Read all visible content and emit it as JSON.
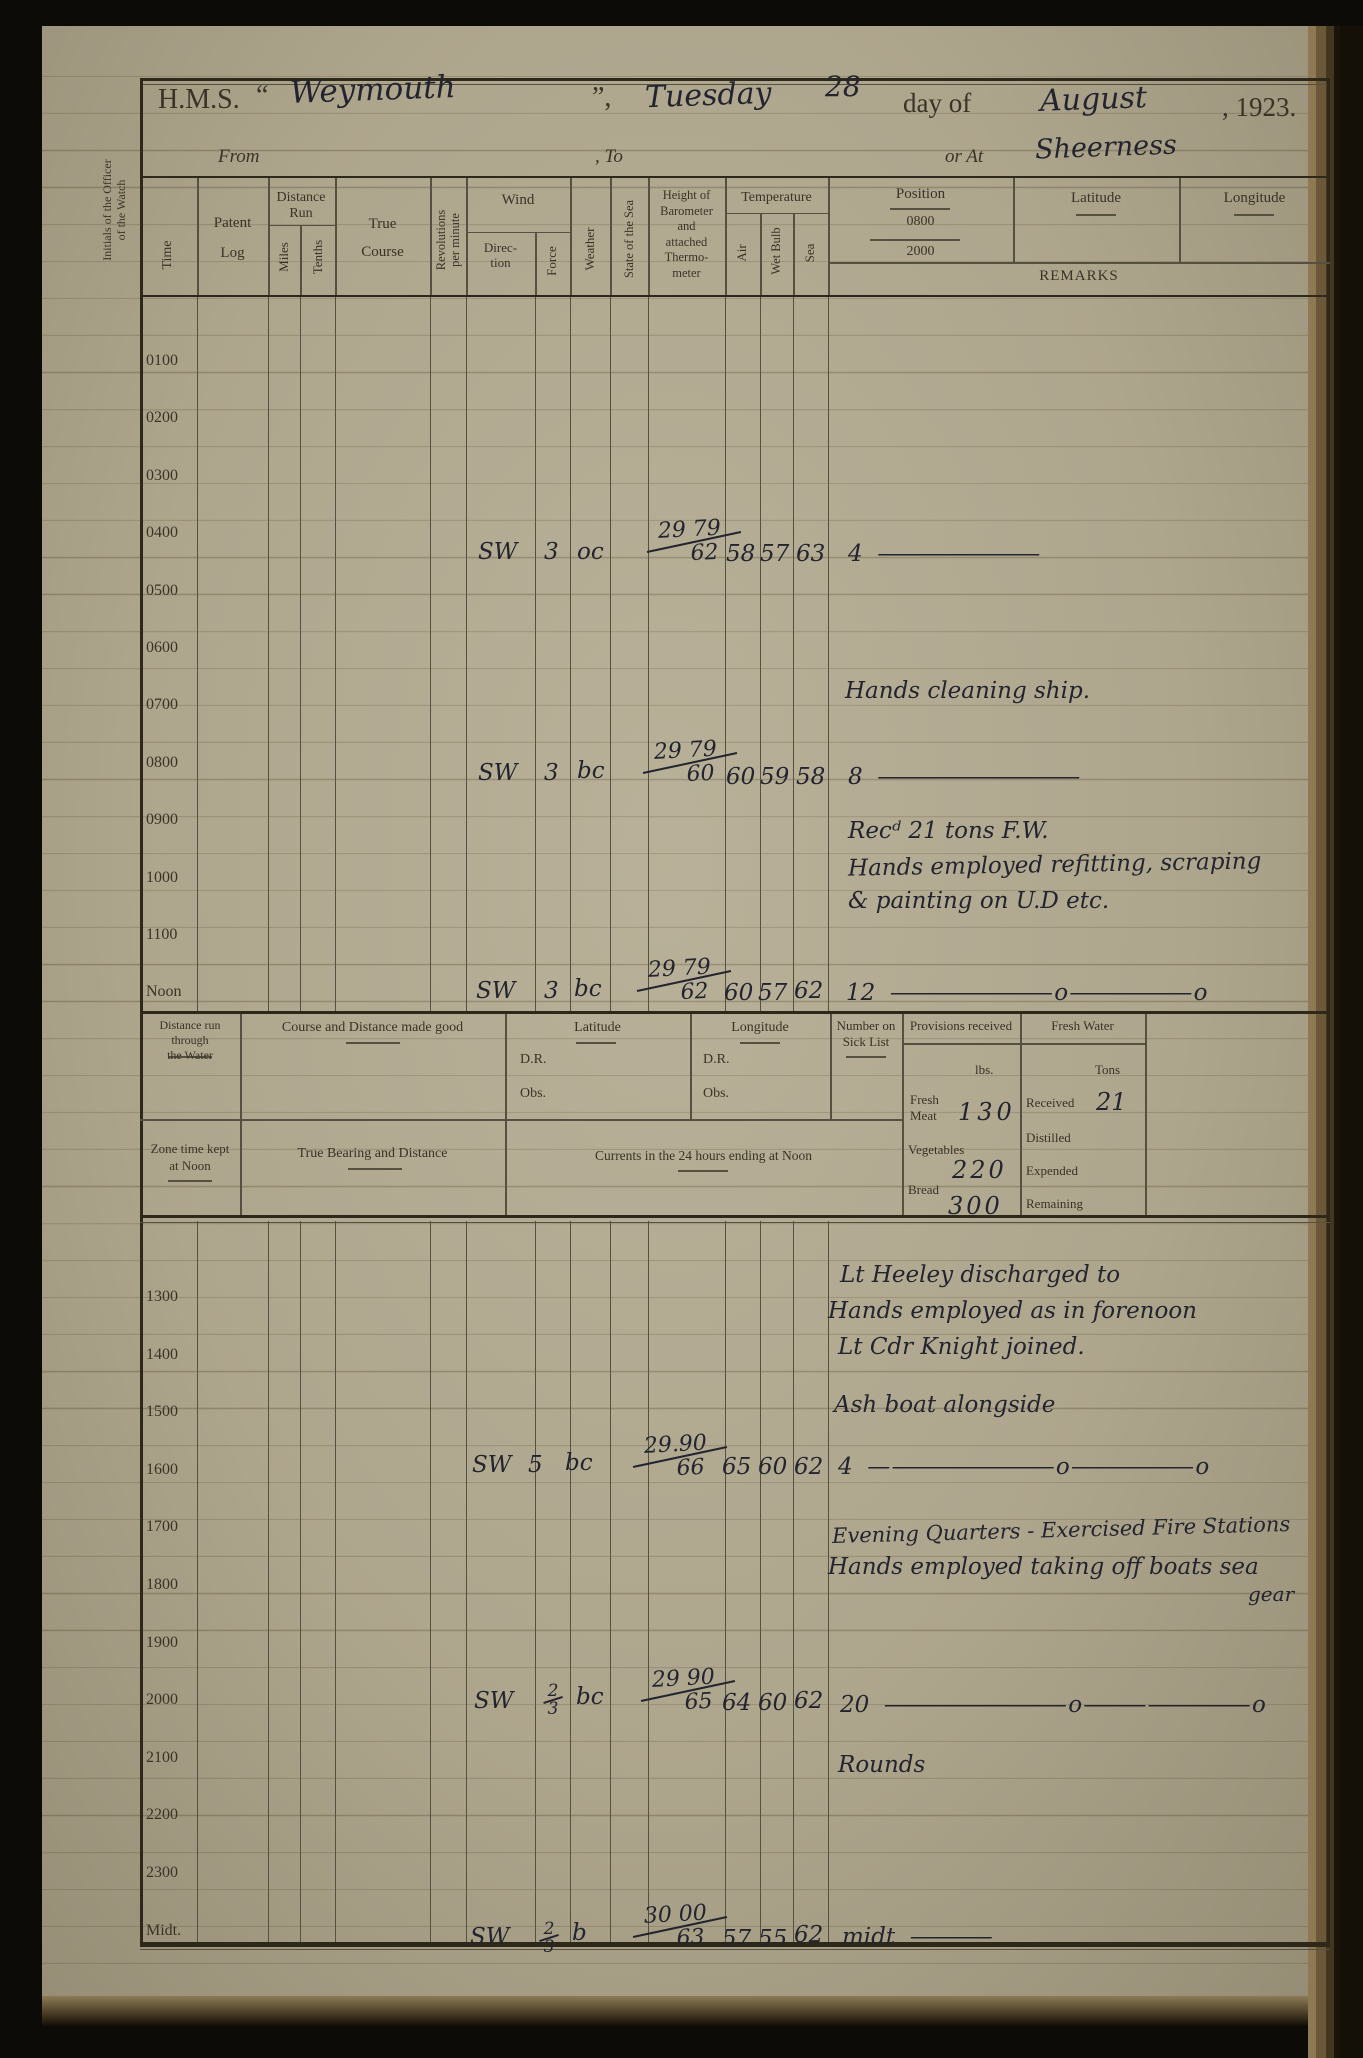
{
  "margin_note_1": "Initials of the Officer",
  "margin_note_2": "of the Watch",
  "title": {
    "hms": "H.M.S.",
    "quote_open": "“",
    "ship": "Weymouth",
    "quote_close": "”,",
    "weekday": "Tuesday",
    "day_num": "28",
    "day_of": "day of",
    "month": "August",
    "year": ", 1923."
  },
  "subtitle": {
    "from": "From",
    "to": ", To",
    "or_at": "or At",
    "place": "Sheerness"
  },
  "headers": {
    "time": "Time",
    "patent_1": "Patent",
    "patent_2": "Log",
    "distance_run": "Distance Run",
    "miles": "Miles",
    "tenths": "Tenths",
    "true_1": "True",
    "true_2": "Course",
    "rev_1": "Revolutions",
    "rev_2": "per minute",
    "wind": "Wind",
    "direction_1": "Direc-",
    "direction_2": "tion",
    "force": "Force",
    "weather": "Weather",
    "state_sea": "State of the Sea",
    "baro_1": "Height of",
    "baro_2": "Barometer",
    "baro_3": "and",
    "baro_4": "attached",
    "baro_5": "Thermo-",
    "baro_6": "meter",
    "temperature": "Temperature",
    "air": "Air",
    "wet_bulb": "Wet Bulb",
    "sea": "Sea",
    "position": "Position",
    "pos_0800": "0800",
    "pos_2000": "2000",
    "latitude": "Latitude",
    "longitude": "Longitude",
    "remarks": "REMARKS"
  },
  "times_morning": [
    "0100",
    "0200",
    "0300",
    "0400",
    "0500",
    "0600",
    "0700",
    "0800",
    "0900",
    "1000",
    "1100",
    "Noon"
  ],
  "times_afternoon": [
    "1300",
    "1400",
    "1500",
    "1600",
    "1700",
    "1800",
    "1900",
    "2000",
    "2100",
    "2200",
    "2300",
    "Midt."
  ],
  "entries": {
    "h0400": {
      "dir": "SW",
      "force": "3",
      "wx": "oc",
      "baro_t": "29 79",
      "baro_b": "62",
      "air": "58",
      "wet": "57",
      "sea": "63",
      "remark": "4",
      "line": "————————"
    },
    "h0800": {
      "dir": "SW",
      "force": "3",
      "wx": "bc",
      "baro_t": "29 79",
      "baro_b": "60",
      "air": "60",
      "wet": "59",
      "sea": "58",
      "remark": "8",
      "line": "——————————"
    },
    "noon": {
      "dir": "SW",
      "force": "3",
      "wx": "bc",
      "baro_t": "29 79",
      "baro_b": "62",
      "air": "60",
      "wet": "57",
      "sea": "62",
      "remark": "12",
      "line": "———————— o —————— o"
    },
    "h1600": {
      "dir": "SW",
      "force": "5",
      "wx": "bc",
      "baro_t": "29.90",
      "baro_b": "66",
      "air": "65",
      "wet": "60",
      "sea": "62",
      "remark": "4",
      "line": "—  ———————— o —————— o"
    },
    "h2000": {
      "dir": "SW",
      "force_t": "2",
      "force_b": "3",
      "wx": "bc",
      "baro_t": "29 90",
      "baro_b": "65",
      "air": "64",
      "wet": "60",
      "sea": "62",
      "remark": "20",
      "line": "————————— o  ——— ————— o"
    },
    "mid": {
      "dir": "SW",
      "force_t": "2",
      "force_b": "3",
      "wx": "b",
      "baro_t": "30 00",
      "baro_b": "63",
      "air": "57",
      "wet": "55",
      "sea": "62",
      "remark": "midt",
      "line": "————"
    }
  },
  "remarks": {
    "m1": "Hands cleaning ship.",
    "m2": "Recᵈ 21 tons F.W.",
    "m3": "Hands employed refitting, scraping",
    "m4": "& painting on U.D etc.",
    "a1": "Lt Heeley discharged to",
    "a2": "Hands employed as in forenoon",
    "a3": "Lt Cdr Knight joined.",
    "a4": "Ash boat alongside",
    "a5": "Evening Quarters -  Exercised Fire Stations",
    "a6": "Hands employed taking off boats sea",
    "a6b": "gear",
    "a7": "Rounds"
  },
  "summary": {
    "dist_water_1": "Distance run through",
    "dist_water_2": "the Water",
    "course_good": "Course and Distance made good",
    "latitude": "Latitude",
    "longitude": "Longitude",
    "dr": "D.R.",
    "obs": "Obs.",
    "sick_1": "Number on",
    "sick_2": "Sick List",
    "provisions_title": "Provisions received",
    "lbs": "lbs.",
    "fresh_1": "Fresh",
    "fresh_2": "Meat",
    "fresh_val": "130",
    "veg_label": "Vegetables",
    "veg_val": "220",
    "bread_label": "Bread",
    "bread_val": "300",
    "fw_title": "Fresh Water",
    "tons": "Tons",
    "received": "Received",
    "received_val": "21",
    "distilled": "Distilled",
    "expended": "Expended",
    "remaining": "Remaining",
    "zone_1": "Zone time kept",
    "zone_2": "at Noon",
    "bearing": "True Bearing and Distance",
    "currents": "Currents in the 24 hours ending at Noon"
  }
}
